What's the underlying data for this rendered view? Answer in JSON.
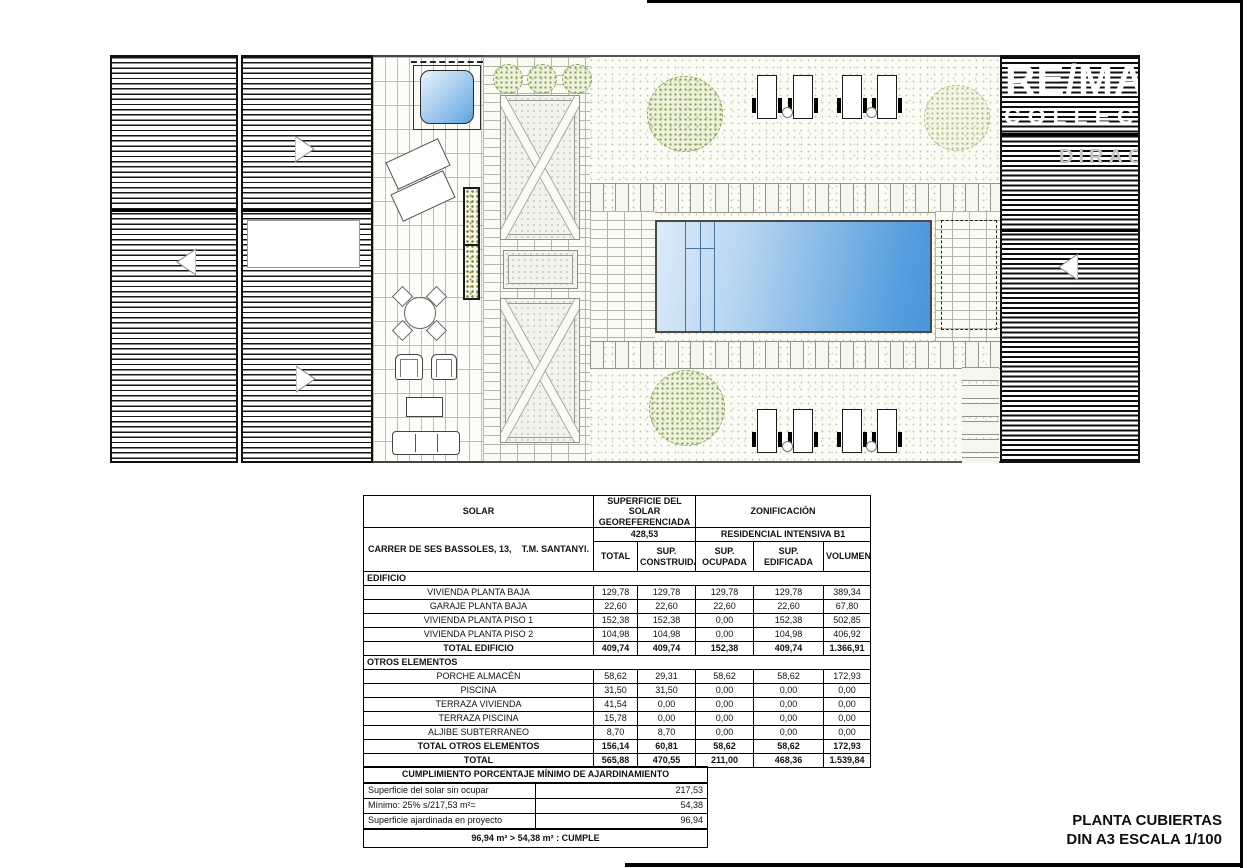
{
  "watermark": {
    "brand": "RE/MA",
    "collection": "COLLECT",
    "extra": "DIRAC"
  },
  "title_block": {
    "line1": "PLANTA CUBIERTAS",
    "line2": "DIN A3 ESCALA 1/100"
  },
  "surfaces_table": {
    "header": {
      "solar": "SOLAR",
      "superficie_l1": "SUPERFICIE DEL SOLAR",
      "superficie_l2": "GEOREFERENCIADA",
      "zonificacion": "ZONIFICACIÓN",
      "superficie_value": "428,53",
      "zonificacion_value": "RESIDENCIAL INTENSIVA B1",
      "address_left": "CARRER DE SES BASSOLES, 13,",
      "address_right": "T.M. SANTANYI.",
      "col_total": "TOTAL",
      "col_sup_l1": "SUP.",
      "col_sup_l2": "CONSTRUIDA",
      "col_ocupada": "SUP. OCUPADA",
      "col_edificada": "SUP. EDIFICADA",
      "col_volumen": "VOLUMEN"
    },
    "rows": [
      {
        "type": "section",
        "label": "EDIFICIO"
      },
      {
        "label": "VIVIENDA PLANTA BAJA",
        "values": [
          "129,78",
          "129,78",
          "129,78",
          "129,78",
          "389,34"
        ]
      },
      {
        "label": "GARAJE PLANTA BAJA",
        "values": [
          "22,60",
          "22,60",
          "22,60",
          "22,60",
          "67,80"
        ]
      },
      {
        "label": "VIVIENDA PLANTA PISO 1",
        "values": [
          "152,38",
          "152,38",
          "0,00",
          "152,38",
          "502,85"
        ]
      },
      {
        "label": "VIVIENDA PLANTA PISO 2",
        "values": [
          "104,98",
          "104,98",
          "0,00",
          "104,98",
          "406,92"
        ]
      },
      {
        "label": "TOTAL EDIFICIO",
        "values": [
          "409,74",
          "409,74",
          "152,38",
          "409,74",
          "1.366,91"
        ]
      },
      {
        "type": "section",
        "label": "OTROS ELEMENTOS"
      },
      {
        "label": "PORCHE ALMACÉN",
        "values": [
          "58,62",
          "29,31",
          "58,62",
          "58,62",
          "172,93"
        ]
      },
      {
        "label": "PISCINA",
        "values": [
          "31,50",
          "31,50",
          "0,00",
          "0,00",
          "0,00"
        ]
      },
      {
        "label": "TERRAZA VIVIENDA",
        "values": [
          "41,54",
          "0,00",
          "0,00",
          "0,00",
          "0,00"
        ]
      },
      {
        "label": "TERRAZA PISCINA",
        "values": [
          "15,78",
          "0,00",
          "0,00",
          "0,00",
          "0,00"
        ]
      },
      {
        "label": "ALJIBE SUBTERRANEO",
        "values": [
          "8,70",
          "8,70",
          "0,00",
          "0,00",
          "0,00"
        ]
      },
      {
        "label": "TOTAL OTROS ELEMENTOS",
        "values": [
          "156,14",
          "60,81",
          "58,62",
          "58,62",
          "172,93"
        ]
      },
      {
        "label": "TOTAL",
        "values": [
          "565,88",
          "470,55",
          "211,00",
          "468,36",
          "1.539,84"
        ]
      }
    ]
  },
  "landscaping_table": {
    "title": "CUMPLIMIENTO PORCENTAJE MÍNIMO DE AJARDINAMIENTO",
    "rows": [
      {
        "label": "Superficie del solar sin ocupar",
        "value": "217,53"
      },
      {
        "label": "Mínimo: 25% s/217,53 m²=",
        "value": "54,38"
      },
      {
        "label": "Superficie ajardinada en proyecto",
        "value": "96,94"
      }
    ],
    "conclusion": "96,94 m²  >  54,38 m²  : CUMPLE"
  }
}
